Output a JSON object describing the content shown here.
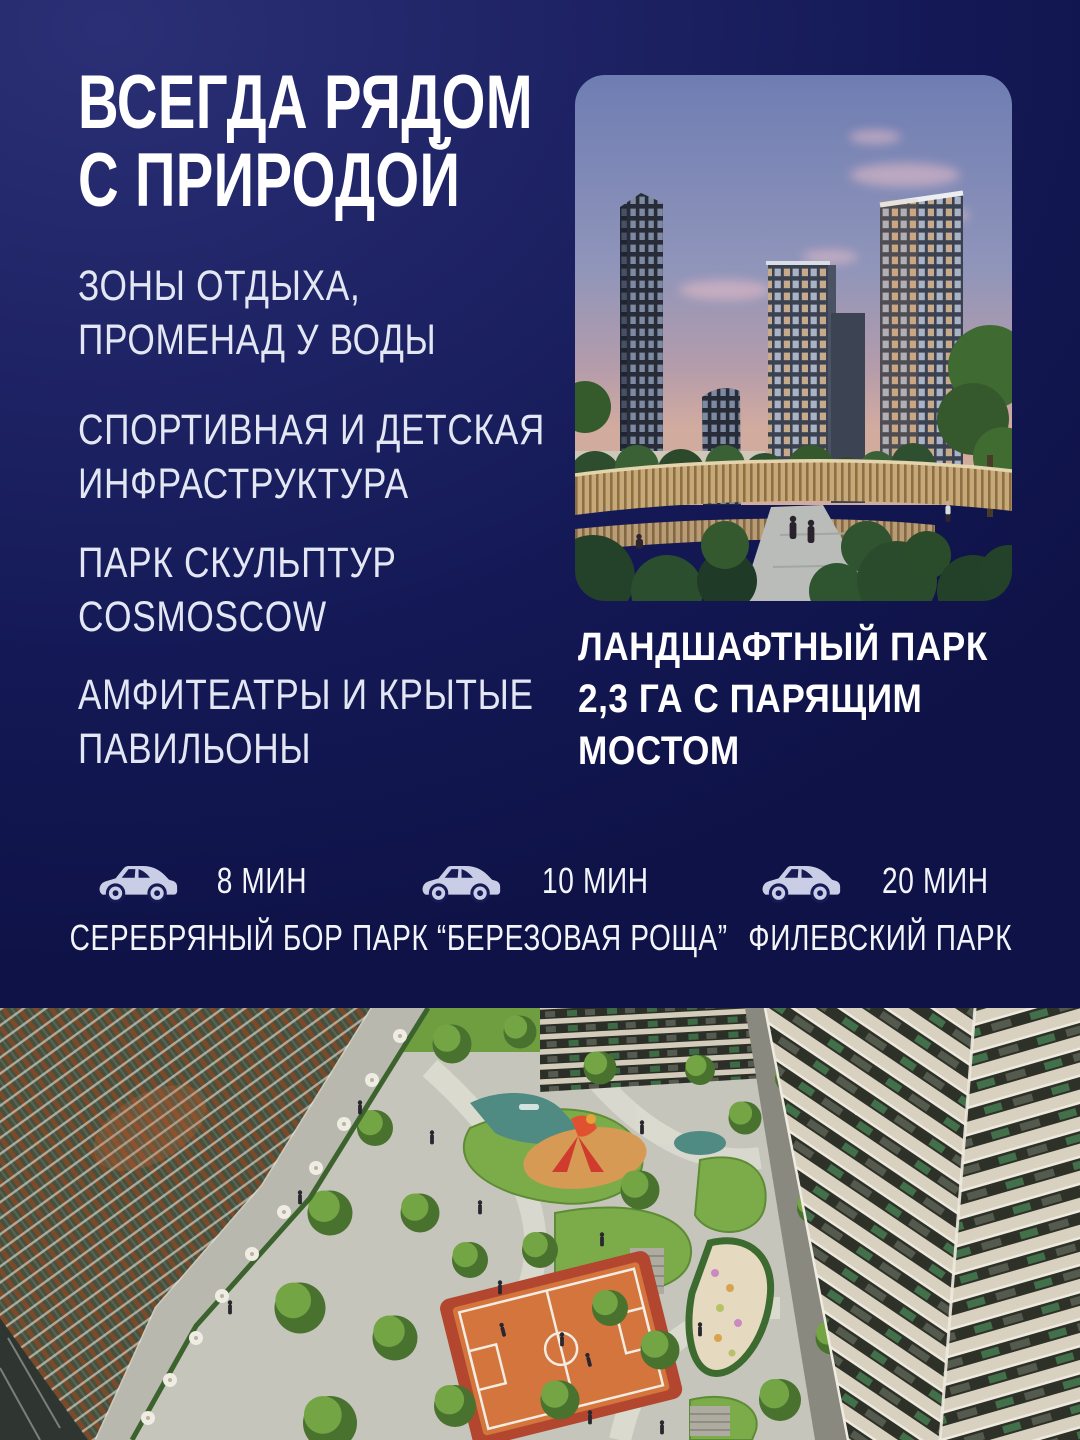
{
  "colors": {
    "background_top": "#2b3076",
    "background_bottom": "#0e1246",
    "text_primary": "#ffffff",
    "text_secondary": "#e3e7f3",
    "car_icon": "#c9cde6"
  },
  "title": "ВСЕГДА РЯДОМ\nС ПРИРОДОЙ",
  "features": [
    "ЗОНЫ ОТДЫХА,\nПРОМЕНАД У ВОДЫ",
    "СПОРТИВНАЯ И ДЕТСКАЯ\nИНФРАСТРУКТУРА",
    "ПАРК СКУЛЬПТУР\nCOSMOSCOW",
    "АМФИТЕАТРЫ И КРЫТЫЕ\nПАВИЛЬОНЫ"
  ],
  "photo_caption": "ЛАНДШАФТНЫЙ ПАРК\n2,3 ГА С ПАРЯЩИМ\nМОСТОМ",
  "photos": {
    "top": "towers-and-landscape-park-at-dusk",
    "bottom": "aerial-view-of-green-courtyard-between-towers"
  },
  "travel": [
    {
      "time": "8 МИН",
      "place": "СЕРЕБРЯНЫЙ БОР"
    },
    {
      "time": "10 МИН",
      "place": "ПАРК “БЕРЕЗОВАЯ РОЩА”"
    },
    {
      "time": "20 МИН",
      "place": "ФИЛЕВСКИЙ ПАРК"
    }
  ]
}
